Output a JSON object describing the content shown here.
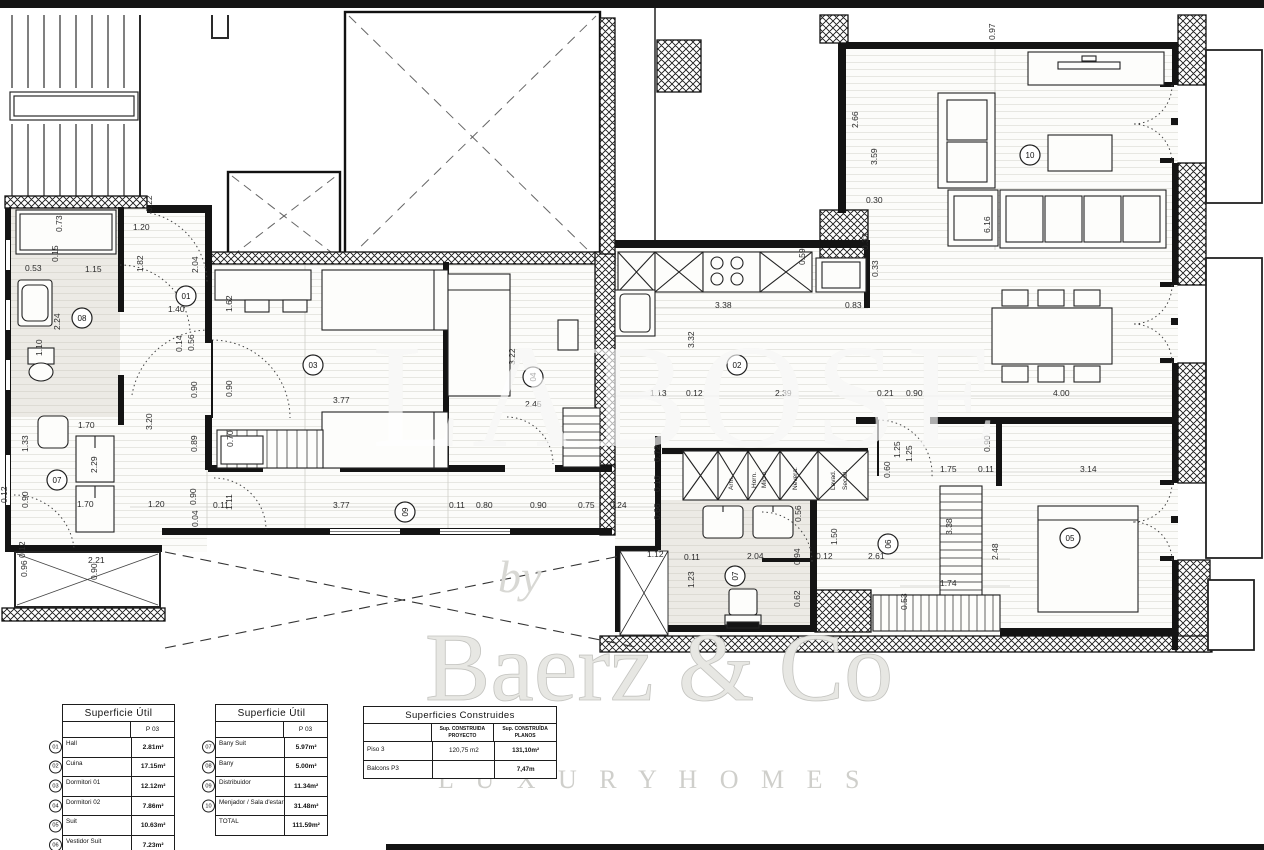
{
  "watermark": {
    "big_text": "LABOSE",
    "by_text": "by",
    "brand_text": "Baerz & Co",
    "tagline_text": "L U X U R Y   H O M E S"
  },
  "rooms": [
    {
      "id": "01",
      "x": 186,
      "y": 296,
      "rot": 0
    },
    {
      "id": "02",
      "x": 737,
      "y": 365,
      "rot": 0
    },
    {
      "id": "03",
      "x": 313,
      "y": 365,
      "rot": 0
    },
    {
      "id": "04",
      "x": 533,
      "y": 377,
      "rot": -90
    },
    {
      "id": "05",
      "x": 1070,
      "y": 538,
      "rot": 0
    },
    {
      "id": "06",
      "x": 888,
      "y": 544,
      "rot": -90
    },
    {
      "id": "07",
      "x": 57,
      "y": 480,
      "rot": 0
    },
    {
      "id": "07",
      "x": 735,
      "y": 576,
      "rot": -90
    },
    {
      "id": "08",
      "x": 82,
      "y": 318,
      "rot": 0
    },
    {
      "id": "09",
      "x": 405,
      "y": 512,
      "rot": -90
    },
    {
      "id": "10",
      "x": 1030,
      "y": 155,
      "rot": 0
    }
  ],
  "dims": [
    [
      62,
      232,
      "0.73",
      1
    ],
    [
      58,
      262,
      "0.15",
      1
    ],
    [
      25,
      271,
      "0.53",
      0
    ],
    [
      85,
      272,
      "1.15",
      0
    ],
    [
      152,
      212,
      "0.22",
      1
    ],
    [
      133,
      230,
      "1.20",
      0
    ],
    [
      143,
      272,
      "1.82",
      1
    ],
    [
      198,
      273,
      "2.04",
      1
    ],
    [
      168,
      312,
      "1.40",
      0
    ],
    [
      232,
      312,
      "1.62",
      1
    ],
    [
      182,
      352,
      "0.14",
      1
    ],
    [
      194,
      351,
      "0.56",
      1
    ],
    [
      197,
      398,
      "0.90",
      1
    ],
    [
      232,
      397,
      "0.90",
      1
    ],
    [
      152,
      430,
      "3.20",
      1
    ],
    [
      197,
      452,
      "0.89",
      1
    ],
    [
      333,
      403,
      "3.77",
      0
    ],
    [
      233,
      447,
      "0.70",
      1
    ],
    [
      60,
      330,
      "2.24",
      1
    ],
    [
      42,
      356,
      "1.10",
      1
    ],
    [
      28,
      452,
      "1.33",
      1
    ],
    [
      78,
      428,
      "1.70",
      0
    ],
    [
      97,
      473,
      "2.29",
      1
    ],
    [
      77,
      507,
      "1.70",
      0
    ],
    [
      28,
      508,
      "0.90",
      1
    ],
    [
      7,
      503,
      "0.12",
      1
    ],
    [
      27,
      577,
      "0.96",
      1
    ],
    [
      88,
      563,
      "2.21",
      0
    ],
    [
      97,
      580,
      "0.90",
      1
    ],
    [
      25,
      558,
      "0.12",
      1
    ],
    [
      148,
      507,
      "1.20",
      0
    ],
    [
      196,
      505,
      "0.90",
      1
    ],
    [
      198,
      527,
      "0.04",
      1
    ],
    [
      213,
      508,
      "0.11",
      0
    ],
    [
      232,
      510,
      "1.11",
      1
    ],
    [
      333,
      508,
      "3.77",
      0
    ],
    [
      449,
      508,
      "0.11",
      0
    ],
    [
      476,
      508,
      "0.80",
      0
    ],
    [
      530,
      508,
      "0.90",
      0
    ],
    [
      578,
      508,
      "0.75",
      0
    ],
    [
      610,
      508,
      "0.24",
      0
    ],
    [
      515,
      365,
      "3.22",
      1
    ],
    [
      525,
      407,
      "2.45",
      0
    ],
    [
      715,
      308,
      "3.38",
      0
    ],
    [
      845,
      308,
      "0.83",
      0
    ],
    [
      805,
      265,
      "0.59",
      1
    ],
    [
      878,
      277,
      "0.33",
      1
    ],
    [
      694,
      348,
      "3.32",
      1
    ],
    [
      650,
      396,
      "1.13",
      0
    ],
    [
      686,
      396,
      "0.12",
      0
    ],
    [
      775,
      396,
      "2.39",
      0
    ],
    [
      877,
      396,
      "0.21",
      0
    ],
    [
      906,
      396,
      "0.90",
      0
    ],
    [
      1053,
      396,
      "4.00",
      0
    ],
    [
      660,
      462,
      "0.72",
      1
    ],
    [
      660,
      492,
      "0.10",
      1
    ],
    [
      660,
      520,
      "0.66",
      1
    ],
    [
      684,
      560,
      "0.11",
      0
    ],
    [
      647,
      557,
      "1.12",
      0
    ],
    [
      747,
      559,
      "2.04",
      0
    ],
    [
      694,
      588,
      "1.23",
      1
    ],
    [
      801,
      522,
      "0.56",
      1
    ],
    [
      800,
      565,
      "0.94",
      1
    ],
    [
      816,
      559,
      "0.12",
      0
    ],
    [
      868,
      559,
      "2.61",
      0
    ],
    [
      837,
      545,
      "1.50",
      1
    ],
    [
      800,
      607,
      "0.62",
      1
    ],
    [
      940,
      586,
      "1.74",
      0
    ],
    [
      907,
      610,
      "0.53",
      1
    ],
    [
      952,
      535,
      "3.38",
      1
    ],
    [
      998,
      560,
      "2.48",
      1
    ],
    [
      990,
      452,
      "0.90",
      1
    ],
    [
      940,
      472,
      "1.75",
      0
    ],
    [
      978,
      472,
      "0.11",
      0
    ],
    [
      1080,
      472,
      "3.14",
      0
    ],
    [
      900,
      458,
      "1.25",
      1
    ],
    [
      912,
      462,
      "1.25",
      1
    ],
    [
      890,
      478,
      "0.60",
      1
    ],
    [
      858,
      128,
      "2.66",
      1
    ],
    [
      877,
      165,
      "3.59",
      1
    ],
    [
      866,
      203,
      "0.30",
      0
    ],
    [
      868,
      250,
      "0.33",
      1
    ],
    [
      990,
      233,
      "6.16",
      1
    ],
    [
      995,
      40,
      "0.97",
      1
    ]
  ],
  "appliance_labels": [
    {
      "t": "Arm.",
      "x": 733,
      "y": 490
    },
    {
      "t": "Horn.",
      "x": 756,
      "y": 488
    },
    {
      "t": "Micro.",
      "x": 766,
      "y": 488
    },
    {
      "t": "Nevera.",
      "x": 797,
      "y": 490
    },
    {
      "t": "Lavad.",
      "x": 835,
      "y": 490
    },
    {
      "t": "Secad.",
      "x": 847,
      "y": 490
    }
  ],
  "tables": {
    "t1": {
      "title": "Superficie Útil",
      "col": "P 03",
      "rows": [
        {
          "num": "01",
          "name": "Hall",
          "value": "2.81m²"
        },
        {
          "num": "02",
          "name": "Cuina",
          "value": "17.15m²"
        },
        {
          "num": "03",
          "name": "Dormitori 01",
          "value": "12.12m²"
        },
        {
          "num": "04",
          "name": "Dormitori 02",
          "value": "7.86m²"
        },
        {
          "num": "05",
          "name": "Suit",
          "value": "10.63m²"
        },
        {
          "num": "06",
          "name": "Vestidor Suit",
          "value": "7.23m²"
        }
      ]
    },
    "t2": {
      "title": "Superficie Útil",
      "col": "P 03",
      "rows": [
        {
          "num": "07",
          "name": "Bany Suit",
          "value": "5.97m²"
        },
        {
          "num": "08",
          "name": "Bany",
          "value": "5.00m²"
        },
        {
          "num": "09",
          "name": "Distribuidor",
          "value": "11.34m²"
        },
        {
          "num": "10",
          "name": "Menjador / Sala d'estar",
          "value": "31.48m²"
        },
        {
          "num": "",
          "name": "TOTAL",
          "value": "111.59m²"
        }
      ]
    },
    "t3": {
      "title": "Superficies Construides",
      "col1_line1": "Sup. CONSTRUIDA",
      "col1_line2": "PROYECTO",
      "col2_line1": "Sup. CONSTRUÏDA",
      "col2_line2": "PLANOS",
      "rows": [
        {
          "name": "Piso 3",
          "v1": "120,75 m2",
          "v2": "131,10m²"
        },
        {
          "name": "Balcons P3",
          "v1": "",
          "v2": "7,47m"
        }
      ]
    }
  }
}
